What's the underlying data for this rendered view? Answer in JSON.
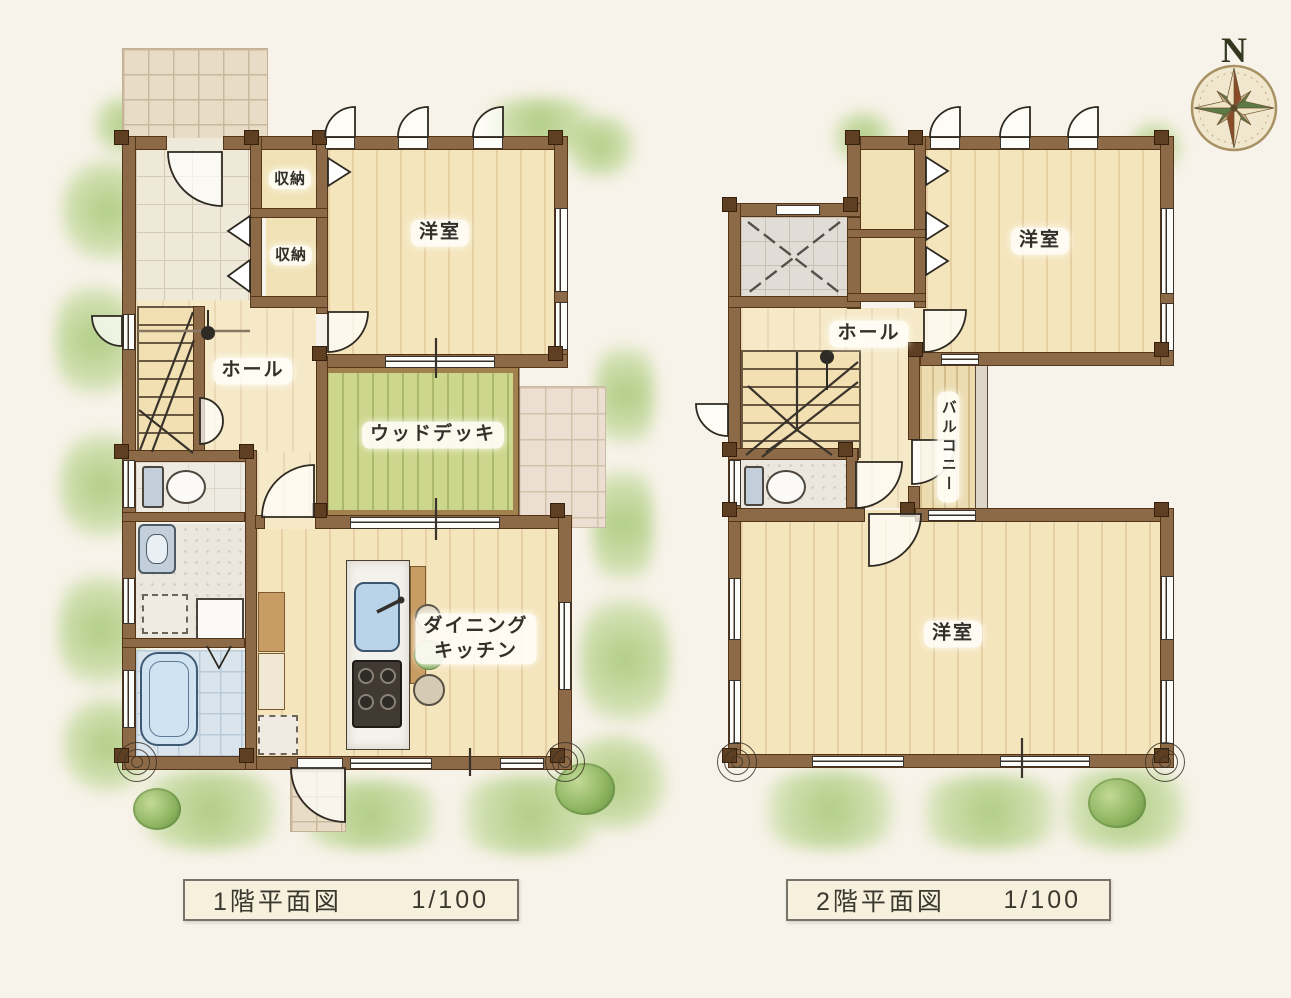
{
  "compass": {
    "north": "N"
  },
  "titles": {
    "floor1": {
      "name": "1階平面図",
      "scale": "1/100"
    },
    "floor2": {
      "name": "2階平面図",
      "scale": "1/100"
    }
  },
  "floor1": {
    "labels": {
      "closet1": "収納",
      "closet2": "収納",
      "western_room": "洋室",
      "hall": "ホール",
      "wood_deck": "ウッドデッキ",
      "dining": "ダイニング",
      "kitchen": "キッチン"
    }
  },
  "floor2": {
    "labels": {
      "hall": "ホール",
      "western_room_top": "洋室",
      "balcony": "バルコニー",
      "western_room_main": "洋室"
    }
  },
  "colors": {
    "wall": "#8c6a47",
    "wood_floor": "#f5e5bd",
    "wood_deck": "#ccd68c",
    "approach_tile": "#e9dcc6",
    "bath_tile": "#d9e4ec",
    "greenery": "#9cc06e",
    "label_text": "#32302a",
    "background": "#f8f3ea"
  }
}
